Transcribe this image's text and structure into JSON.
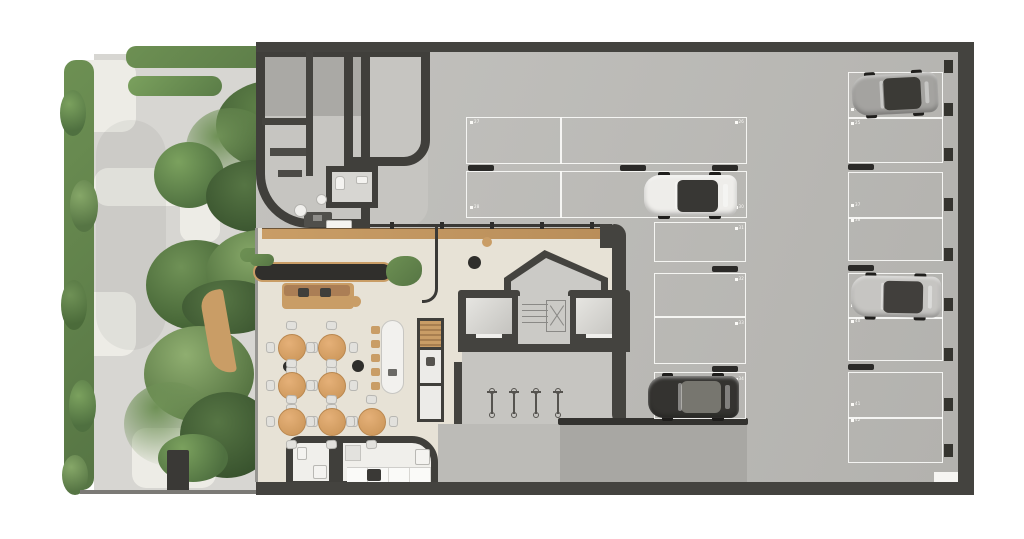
{
  "scene": {
    "title": "Residential ground-floor plan with lounge, core and parking garage",
    "floor_type": "architectural top-down floor plan"
  },
  "colors": {
    "wall": "#44433f",
    "garage_floor": "#bcbbb7",
    "lobby_floor": "#e7e2d6",
    "sidewalk": "#d7d6d2",
    "paving": "#edece6",
    "grass": "#5e8148",
    "wood": "#c99d66",
    "parking_line": "#faf9f7",
    "table_top": "#d9a368"
  },
  "parking": {
    "labels": [
      {
        "x": 470,
        "y": 120,
        "n": "27",
        "a": "l"
      },
      {
        "x": 744,
        "y": 120,
        "n": "26",
        "a": "r"
      },
      {
        "x": 470,
        "y": 205,
        "n": "28",
        "a": "l"
      },
      {
        "x": 744,
        "y": 205,
        "n": "30",
        "a": "r"
      },
      {
        "x": 744,
        "y": 226,
        "n": "31",
        "a": "r"
      },
      {
        "x": 744,
        "y": 277,
        "n": "32",
        "a": "r"
      },
      {
        "x": 744,
        "y": 321,
        "n": "33",
        "a": "r"
      },
      {
        "x": 744,
        "y": 377,
        "n": "34",
        "a": "r"
      },
      {
        "x": 851,
        "y": 107,
        "n": "24",
        "a": "l"
      },
      {
        "x": 851,
        "y": 121,
        "n": "25",
        "a": "l"
      },
      {
        "x": 851,
        "y": 203,
        "n": "37",
        "a": "l"
      },
      {
        "x": 851,
        "y": 218,
        "n": "38",
        "a": "l"
      },
      {
        "x": 851,
        "y": 303,
        "n": "39",
        "a": "l"
      },
      {
        "x": 851,
        "y": 319,
        "n": "40",
        "a": "l"
      },
      {
        "x": 851,
        "y": 402,
        "n": "41",
        "a": "l"
      },
      {
        "x": 851,
        "y": 418,
        "n": "42",
        "a": "l"
      }
    ],
    "wheel_stops": [
      [
        468,
        165
      ],
      [
        620,
        165
      ],
      [
        712,
        165
      ],
      [
        712,
        266
      ],
      [
        712,
        366
      ],
      [
        848,
        164
      ],
      [
        848,
        265
      ],
      [
        848,
        364
      ]
    ],
    "wall_columns_y": [
      60,
      103,
      148,
      198,
      248,
      298,
      348,
      398,
      444
    ]
  },
  "cars": [
    {
      "name": "car-gray-top",
      "x": 852,
      "y": 74,
      "w": 86,
      "h": 40,
      "body": "#a4a3a0",
      "glass": "#3b3a36",
      "rot": -3
    },
    {
      "name": "car-white-mid",
      "x": 644,
      "y": 175,
      "w": 93,
      "h": 41,
      "body": "#eeedea",
      "glass": "#383734",
      "rot": 0
    },
    {
      "name": "car-silver-right",
      "x": 851,
      "y": 276,
      "w": 90,
      "h": 41,
      "body": "#c6c5c2",
      "glass": "#413f3c",
      "rot": 1
    },
    {
      "name": "car-black-low",
      "x": 648,
      "y": 376,
      "w": 91,
      "h": 42,
      "body": "#343330",
      "glass": "#77766f",
      "rot": 0
    }
  ],
  "furniture": {
    "cafe_tables": [
      [
        292,
        348
      ],
      [
        332,
        348
      ],
      [
        292,
        386
      ],
      [
        332,
        386
      ],
      [
        292,
        422
      ],
      [
        332,
        422
      ],
      [
        372,
        422
      ]
    ],
    "island_stools_y": [
      326,
      340,
      354,
      368,
      382
    ],
    "island_stools_x": 371,
    "bike_rack_x": [
      486,
      508,
      530,
      552
    ],
    "bike_rack_y": 388
  }
}
